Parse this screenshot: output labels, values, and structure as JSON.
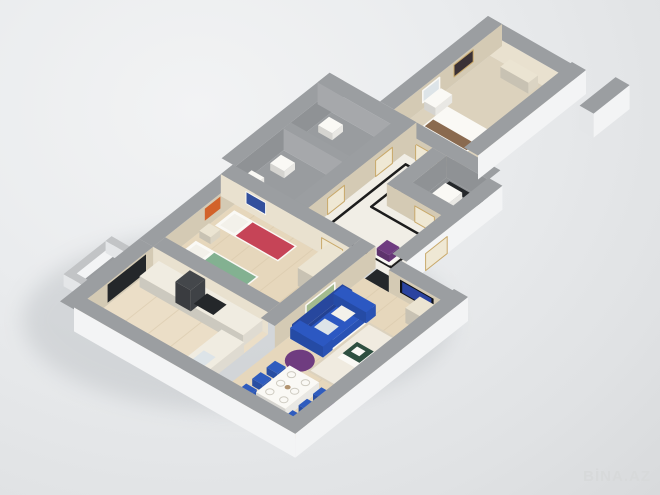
{
  "watermark": {
    "text": "BİNA.AZ"
  },
  "scene": {
    "kind": "3d-apartment-floor-plan-render"
  },
  "colors": {
    "wallTop": "#9b9ea1",
    "wallTopLight": "#c2c4c6",
    "extWall": "#f3f4f5",
    "extWallShade": "#e4e6e8",
    "beigeWall": "#d4cab4",
    "creamWall": "#e9e1cf",
    "grayWall": "#8f9295",
    "grayWallLight": "#a6a8ab",
    "grayFloor": "#999c9f",
    "grayFloorDark": "#8e9194",
    "marble": "#f1eee6",
    "marbleBorder": "#1c1c1c",
    "woodFloor": "#e6d7bc",
    "woodFloorLight": "#ebdec7",
    "bedroomFloor": "#dcd2bd",
    "plank": "#d9c9ac",
    "sofaBlue": "#2c58c2",
    "sofaBlueDark": "#27479e",
    "chairBlue": "#2f5cbe",
    "purple": "#6f3c80",
    "purpleLight": "#8a4f9b",
    "red": "#c64457",
    "green": "#83b191",
    "orange": "#d2622a",
    "posterBlue": "#33509d",
    "portrait": "#3a3136",
    "cream": "#ebe4d2",
    "counter": "#f0ece1",
    "hood": "#44474b",
    "white": "#faf9f5",
    "dark": "#24272a",
    "tvDark": "#101216",
    "tvScreen": "#2a43a0",
    "paintGreen": "#a3bb8e",
    "door": "#efe8d4",
    "gold": "#c9a96a",
    "mirror": "#dde4e8",
    "pillow": "#f3f1ea",
    "headboard": "#b2936f",
    "bedStripe": "#8a6a4f",
    "rug": "#f0ebe0",
    "rugBorder": "#dcd2be",
    "plateEdge": "#cfccc2",
    "tableGreen": "#2e4f40",
    "plantGreen": "#4e7b46",
    "shadow": "#b9bdc1",
    "watermark": "#d7d9da",
    "background": "#e8eaec"
  }
}
